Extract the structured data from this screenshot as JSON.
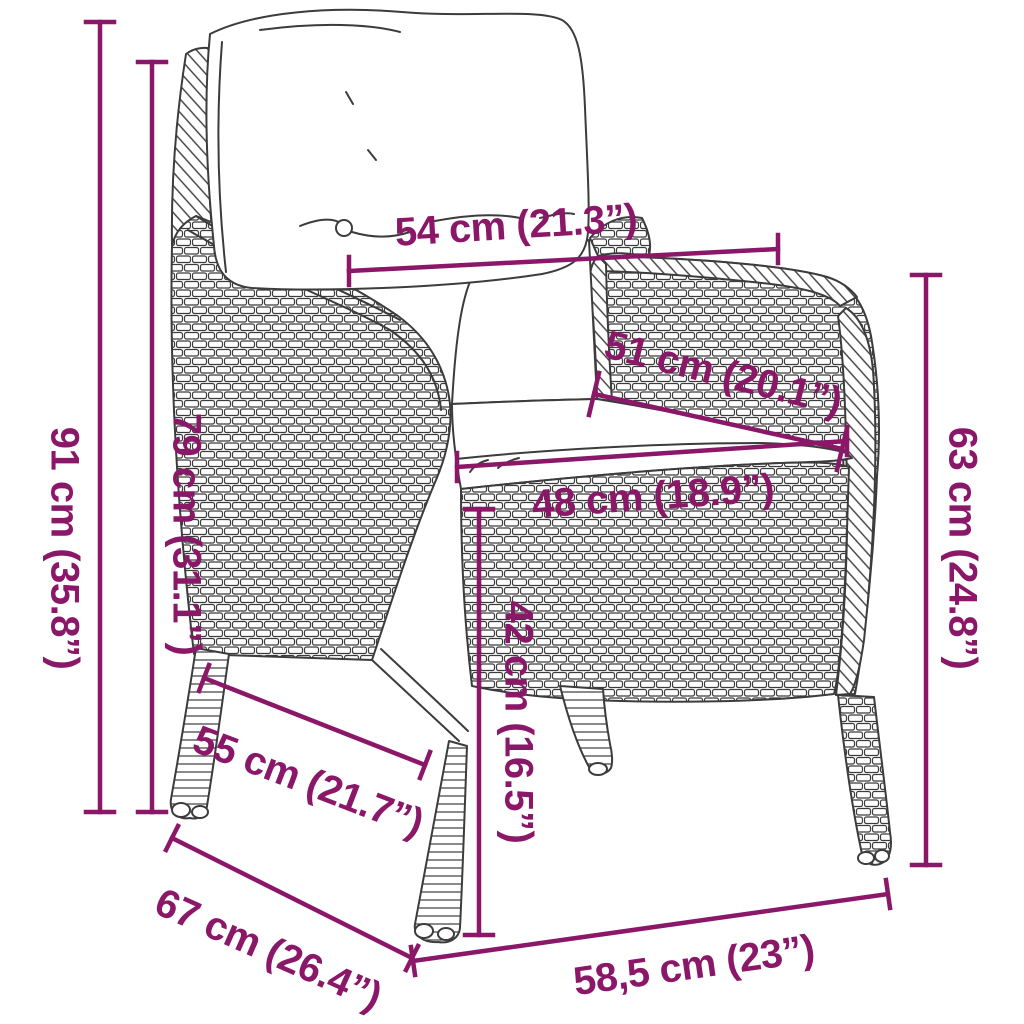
{
  "diagram": {
    "type": "product-dimension-diagram",
    "subject": "poly-rattan garden chair with back and seat cushions",
    "colors": {
      "dimension_accent": "#8B1769",
      "artwork_line": "#3C3C3C",
      "background": "#FFFFFF"
    },
    "dimensions": [
      {
        "id": "overall-height",
        "label": "91 cm (35.8”)"
      },
      {
        "id": "back-height",
        "label": "79 cm (31.1”)"
      },
      {
        "id": "back-width",
        "label": "54 cm (21.3”)"
      },
      {
        "id": "backrest-width",
        "label": "51 cm (20.1”)"
      },
      {
        "id": "seat-width",
        "label": "48 cm (18.9”)"
      },
      {
        "id": "seat-height",
        "label": "42 cm (16.5”)"
      },
      {
        "id": "armrest-height",
        "label": "63 cm (24.8”)"
      },
      {
        "id": "seat-depth",
        "label": "55 cm (21.7”)"
      },
      {
        "id": "overall-depth",
        "label": "67 cm (26.4”)"
      },
      {
        "id": "base-width",
        "label": "58,5 cm (23”)"
      }
    ]
  }
}
